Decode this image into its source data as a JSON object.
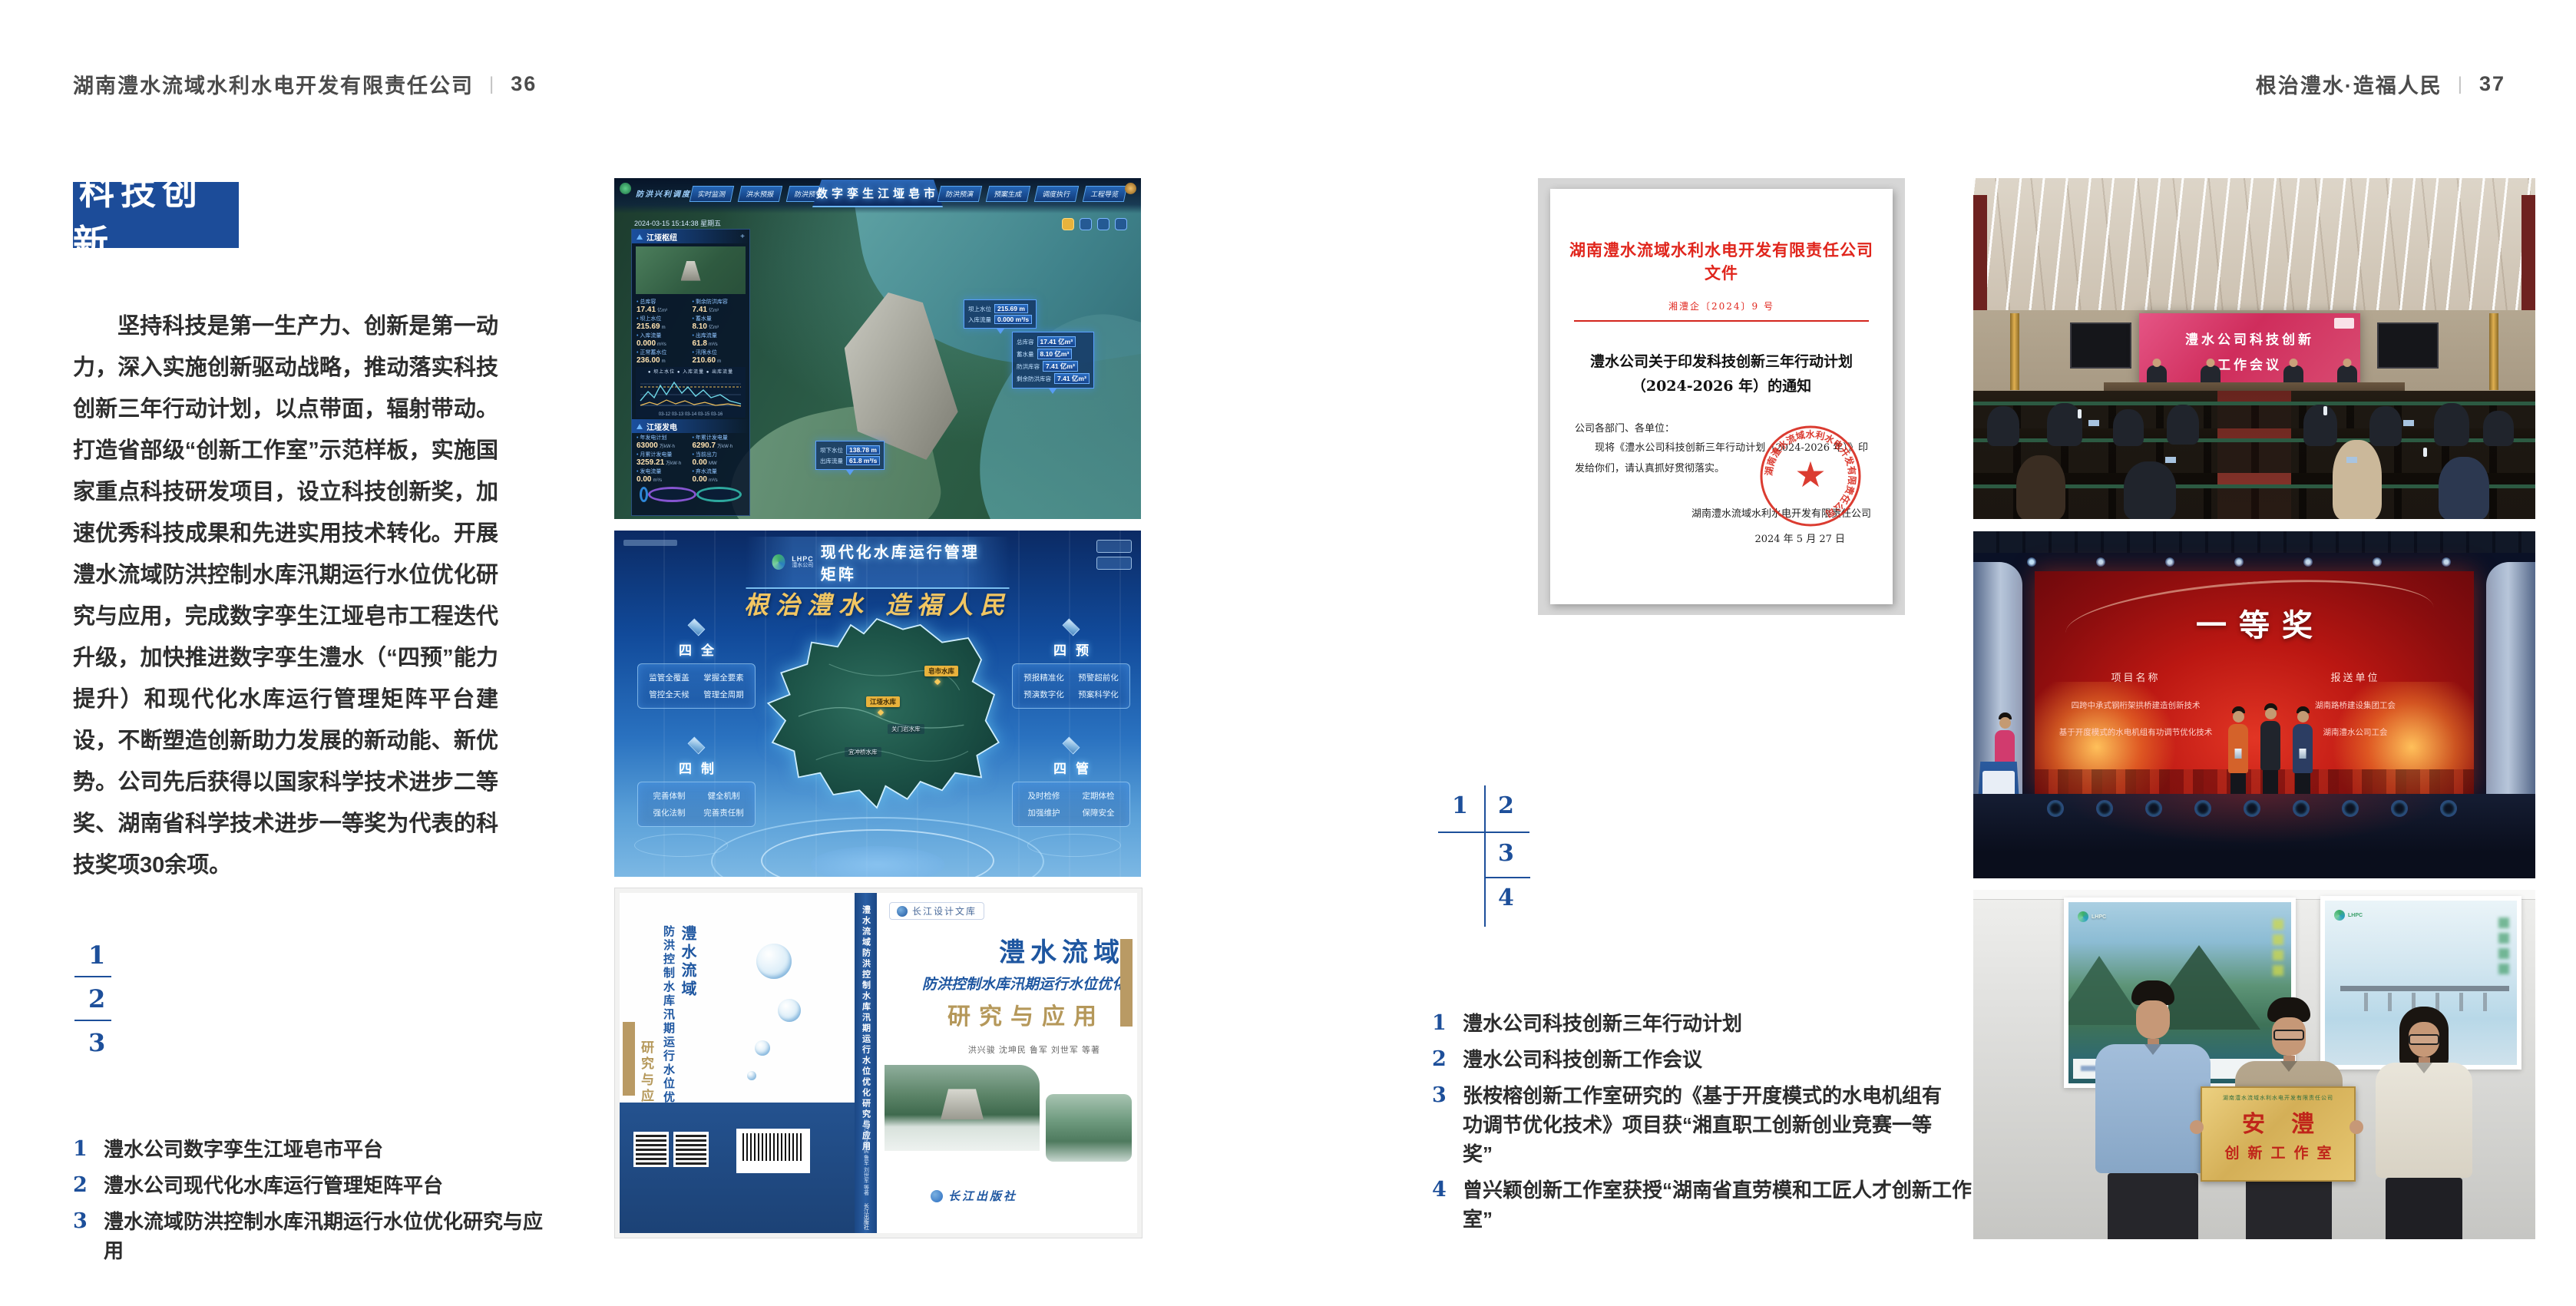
{
  "header": {
    "left": {
      "company": "湖南澧水流域水利水电开发有限责任公司",
      "separator": "|",
      "page": "36"
    },
    "right": {
      "slogan": "根治澧水·造福人民",
      "separator": "|",
      "page": "37"
    }
  },
  "left_page": {
    "badge": "科技创新",
    "paragraph": "坚持科技是第一生产力、创新是第一动力，深入实施创新驱动战略，推动落实科技创新三年行动计划，以点带面，辐射带动。打造省部级“创新工作室”示范样板，实施国家重点科技研发项目，设立科技创新奖，加速优秀科技成果和先进实用技术转化。开展澧水流域防洪控制水库汛期运行水位优化研究与应用，完成数字孪生江垭皂市工程迭代升级，加快推进数字孪生澧水（“四预”能力提升）和现代化水库运行管理矩阵平台建设，不断塑造创新助力发展的新动能、新优势。公司先后获得以国家科学技术进步二等奖、湖南省科学技术进步一等奖为代表的科技奖项30余项。",
    "figure_numbers": [
      "1",
      "2",
      "3"
    ],
    "captions": [
      {
        "num": "1",
        "text": "澧水公司数字孪生江垭皂市平台"
      },
      {
        "num": "2",
        "text": "澧水公司现代化水库运行管理矩阵平台"
      },
      {
        "num": "3",
        "text": "澧水流域防洪控制水库汛期运行水位优化研究与应用"
      }
    ]
  },
  "fig_digital_twin": {
    "title": "数字孪生江垭皂市",
    "module_label": "防洪兴利调度",
    "tabs_left": [
      "实时监测",
      "洪水预报",
      "防洪预警"
    ],
    "tabs_right": [
      "防洪预演",
      "预案生成",
      "调度执行",
      "工程导览"
    ],
    "datetime": "2024-03-15 15:14:38 星期五",
    "panel1_title": "江垭枢纽",
    "panel1_stats": [
      {
        "label": "总库容",
        "value": "17.41",
        "unit": "亿m³"
      },
      {
        "label": "剩余防洪库容",
        "value": "7.41",
        "unit": "亿m³"
      },
      {
        "label": "坝上水位",
        "value": "215.69",
        "unit": "m"
      },
      {
        "label": "蓄水量",
        "value": "8.10",
        "unit": "亿m³"
      },
      {
        "label": "入库流量",
        "value": "0.000",
        "unit": "m³/s"
      },
      {
        "label": "出库流量",
        "value": "61.8",
        "unit": "m³/s"
      },
      {
        "label": "正常蓄水位",
        "value": "236.00",
        "unit": "m"
      },
      {
        "label": "汛限水位",
        "value": "210.60",
        "unit": "m"
      }
    ],
    "chart_legend": "● 坝上水位  ● 入库流量  ● 出库流量",
    "chart_xticks": "03-12  03-13  03-14  03-15  03-16",
    "panel2_title": "江垭发电",
    "panel2_stats": [
      {
        "label": "年发电计划",
        "value": "63000",
        "unit": "万kW·h"
      },
      {
        "label": "年累计发电量",
        "value": "6290.7",
        "unit": "万kW·h"
      },
      {
        "label": "月累计发电量",
        "value": "3259.21",
        "unit": "万kW·h"
      },
      {
        "label": "当前出力",
        "value": "0.00",
        "unit": "MW"
      },
      {
        "label": "发电流量",
        "value": "0.00",
        "unit": "m³/s"
      },
      {
        "label": "弃水流量",
        "value": "0.00",
        "unit": "m³/s"
      }
    ],
    "callout1": [
      {
        "label": "坝上水位",
        "value": "215.69 m"
      },
      {
        "label": "入库流量",
        "value": "0.000 m³/s"
      }
    ],
    "callout2": [
      {
        "label": "总库容",
        "value": "17.41 亿m³"
      },
      {
        "label": "蓄水量",
        "value": "8.10 亿m³"
      },
      {
        "label": "防洪库容",
        "value": "7.41 亿m³"
      },
      {
        "label": "剩余防洪库容",
        "value": "7.41 亿m³"
      }
    ],
    "callout3": [
      {
        "label": "坝下水位",
        "value": "138.78 m"
      },
      {
        "label": "出库流量",
        "value": "61.8 m³/s"
      }
    ]
  },
  "fig_matrix": {
    "logo_abbr": "LHPC",
    "logo_name": "澧水公司",
    "title": "现代化水库运行管理矩阵",
    "slogan": "根治澧水 造福人民",
    "corners": [
      {
        "title": "四全",
        "items": [
          "监管全覆盖",
          "掌握全要素",
          "管控全天候",
          "管理全周期"
        ]
      },
      {
        "title": "四预",
        "items": [
          "预报精准化",
          "预警超前化",
          "预演数字化",
          "预案科学化"
        ]
      },
      {
        "title": "四制",
        "items": [
          "完善体制",
          "健全机制",
          "强化法制",
          "完善责任制"
        ]
      },
      {
        "title": "四管",
        "items": [
          "及时检修",
          "定期体检",
          "加强维护",
          "保障安全"
        ]
      }
    ],
    "map_labels": [
      "皂市水库",
      "江垭水库",
      "关门岩水库",
      "宜冲桥水库"
    ]
  },
  "fig_book": {
    "series": "长江设计文库",
    "title1": "澧水流域",
    "title2": "防洪控制水库汛期运行水位优化",
    "title3": "研究与应用",
    "authors": "洪兴骏 沈坤民 鲁军 刘世军 等著",
    "spine_title": "澧水流域防洪控制水库汛期运行水位优化研究与应用",
    "publisher": "长江出版社"
  },
  "right_page": {
    "document": {
      "header": "湖南澧水流域水利水电开发有限责任公司文件",
      "doc_no": "湘澧企〔2024〕9 号",
      "title1": "澧水公司关于印发科技创新三年行动计划",
      "title2": "（2024-2026 年）的通知",
      "salutation": "公司各部门、各单位：",
      "body": "现将《澧水公司科技创新三年行动计划（2024-2026 年）》印发给你们，请认真抓好贯彻落实。",
      "signer": "湖南澧水流域水利水电开发有限责任公司",
      "date": "2024 年 5 月 27 日"
    },
    "figure_numbers": [
      "1",
      "2",
      "3",
      "4"
    ],
    "captions": [
      {
        "num": "1",
        "text": "澧水公司科技创新三年行动计划"
      },
      {
        "num": "2",
        "text": "澧水公司科技创新工作会议"
      },
      {
        "num": "3",
        "text": "张桉榕创新工作室研究的《基于开度模式的水电机组有功调节优化技术》项目获“湘直职工创新创业竞赛一等奖”"
      },
      {
        "num": "4",
        "text": "曾兴颖创新工作室获授“湖南省直劳模和工匠人才创新工作室”"
      }
    ],
    "photo_meeting": {
      "screen_line1": "澧水公司科技创新",
      "screen_line2": "工作会议"
    },
    "photo_award": {
      "award": "一等奖",
      "col1": "项目名称",
      "col2": "报送单位",
      "rows": [
        [
          "四跨中承式钢桁架拱桥建造创新技术",
          "湖南路桥建设集团工会"
        ],
        [
          "基于开度模式的水电机组有功调节优化技术",
          "湖南澧水公司工会"
        ]
      ]
    },
    "photo_group": {
      "plaque_header": "湖南澧水流域水利水电开发有限责任公司",
      "plaque_title": "安澧",
      "plaque_sub": "创新工作室"
    }
  }
}
